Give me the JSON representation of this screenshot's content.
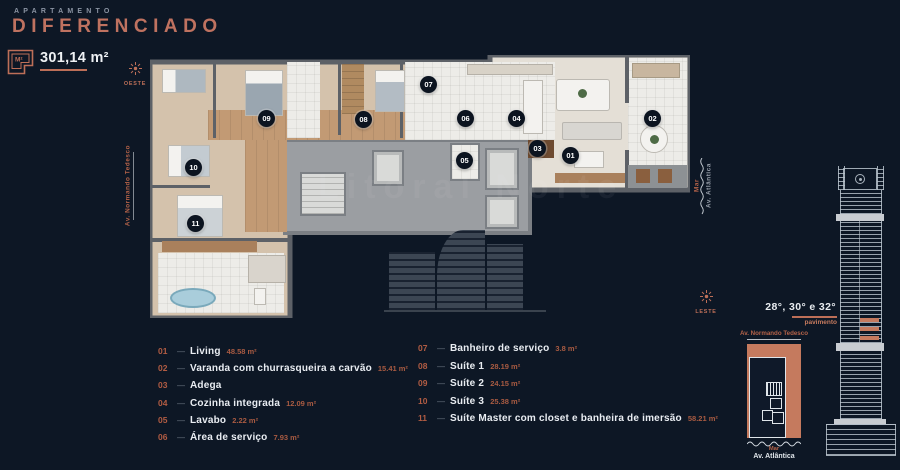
{
  "colors": {
    "background": "#0d1725",
    "accent_coral": "#bd6f58",
    "title_coral": "#bf7260",
    "keyplan_fill": "#c57a5e",
    "text_primary": "#e9edf2",
    "text_muted": "#8b94a3",
    "marker_bg": "#0c1420"
  },
  "header": {
    "eyebrow": "APARTAMENTO",
    "title": "DIFERENCIADO"
  },
  "area_badge": {
    "icon_label": "M²",
    "value": "301,14 m²"
  },
  "compass": {
    "west_label": "OESTE",
    "east_label": "LESTE"
  },
  "streets": {
    "left_avenue": "Av. Normando Tedesco",
    "sea": "Mar",
    "right_avenue": "Av. Atlântica"
  },
  "watermark": "Litoral Norte",
  "floorplan": {
    "markers": [
      {
        "num": "01"
      },
      {
        "num": "02"
      },
      {
        "num": "03"
      },
      {
        "num": "04"
      },
      {
        "num": "05"
      },
      {
        "num": "06"
      },
      {
        "num": "07"
      },
      {
        "num": "08"
      },
      {
        "num": "09"
      },
      {
        "num": "10"
      },
      {
        "num": "11"
      }
    ]
  },
  "legend": {
    "separator": "—",
    "left": [
      {
        "num": "01",
        "label": "Living",
        "area": "48.58 m²"
      },
      {
        "num": "02",
        "label": "Varanda com churrasqueira a carvão",
        "area": "15.41 m²"
      },
      {
        "num": "03",
        "label": "Adega",
        "area": ""
      },
      {
        "num": "04",
        "label": "Cozinha integrada",
        "area": "12.09 m²"
      },
      {
        "num": "05",
        "label": "Lavabo",
        "area": "2.22 m²"
      },
      {
        "num": "06",
        "label": "Área de serviço",
        "area": "7.93 m²"
      }
    ],
    "right": [
      {
        "num": "07",
        "label": "Banheiro de serviço",
        "area": "3.8 m²"
      },
      {
        "num": "08",
        "label": "Suíte 1",
        "area": "28.19 m²"
      },
      {
        "num": "09",
        "label": "Suíte 2",
        "area": "24.15 m²"
      },
      {
        "num": "10",
        "label": "Suíte 3",
        "area": "25.38 m²"
      },
      {
        "num": "11",
        "label": "Suíte Master com closet e banheira de imersão",
        "area": "58.21 m²"
      }
    ]
  },
  "elevation": {
    "floors": "28°, 30° e 32°",
    "sublabel": "pavimento"
  },
  "keyplan": {
    "top_label": "Av. Normando Tedesco",
    "sea_label": "Mar",
    "avenue_label": "Av. Atlântica"
  }
}
